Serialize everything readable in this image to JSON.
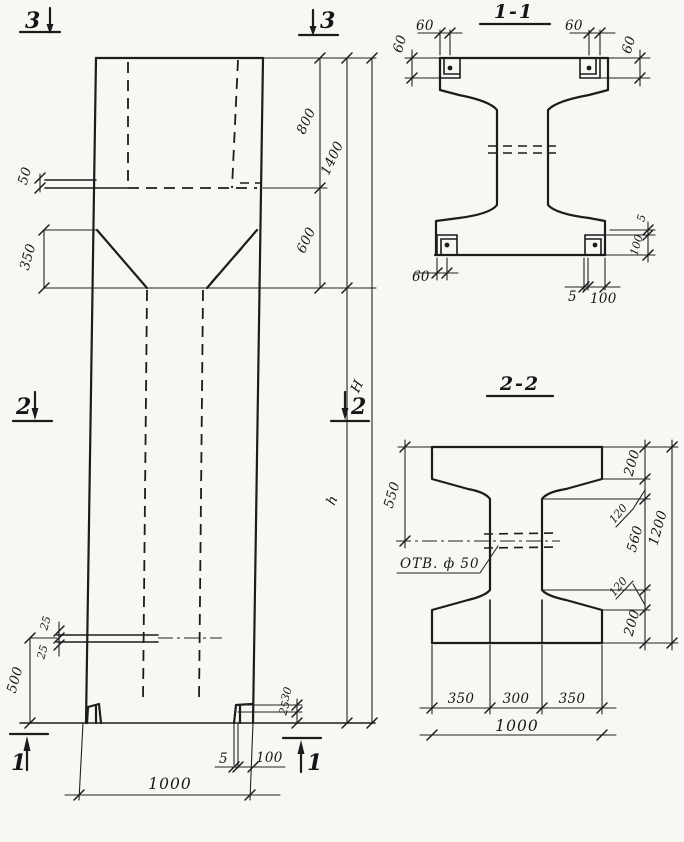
{
  "palette": {
    "ink": "#1c1c1c",
    "paper": "#f8f7f3"
  },
  "elevation": {
    "marks": {
      "top_left": "3",
      "top_right": "3",
      "mid_left": "2",
      "mid_right": "2",
      "bottom_left": "1",
      "bottom_right": "1"
    },
    "dims": {
      "step": "50",
      "corbel": "350",
      "hole_top": "25",
      "hole_bottom": "25",
      "base_height": "500",
      "head_upper": "800",
      "head_total": "1400",
      "taper": "600",
      "total_height": "H",
      "shaft_height": "h",
      "foot_a": "30",
      "foot_b": "25",
      "plate_thickness": "5",
      "plate_width": "100",
      "width": "1000"
    }
  },
  "section_1_1": {
    "title": "1-1",
    "dims": {
      "top_left_offset": "60",
      "top_left_depth": "60",
      "top_right_offset": "60",
      "top_right_depth": "60",
      "bottom_left_offset": "60",
      "bottom_plate_thickness": "5",
      "bottom_plate_width": "100",
      "right_gap": "5",
      "right_plate_height": "100"
    }
  },
  "section_2_2": {
    "title": "2-2",
    "hole_label": "ОТВ. ф 50",
    "dims": {
      "flange_width_left": "550",
      "right_200_top": "200",
      "right_120_top": "120",
      "right_560": "560",
      "right_120_bottom": "120",
      "right_200_bottom": "200",
      "right_total": "1200",
      "bottom_350_left": "350",
      "bottom_300": "300",
      "bottom_350_right": "350",
      "bottom_total": "1000"
    }
  }
}
